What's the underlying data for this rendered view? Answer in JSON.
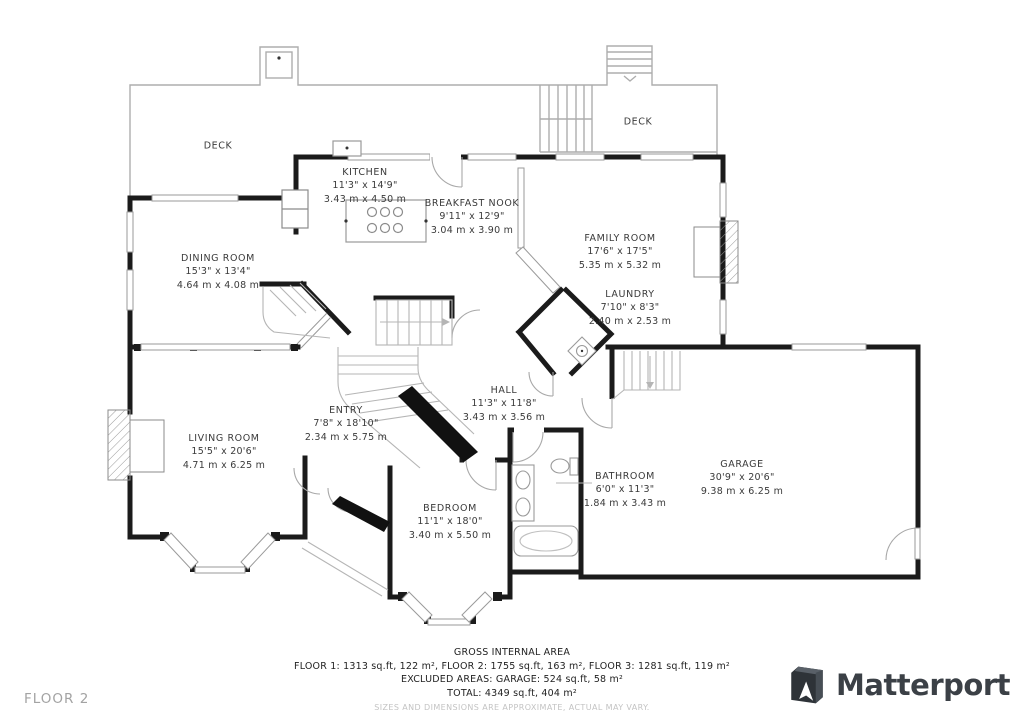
{
  "floor_label": "FLOOR 2",
  "brand": {
    "name": "Matterport"
  },
  "rooms": [
    {
      "id": "deck-left",
      "name": "DECK",
      "dims_ft": "",
      "dims_m": ""
    },
    {
      "id": "deck-right",
      "name": "DECK",
      "dims_ft": "",
      "dims_m": ""
    },
    {
      "id": "kitchen",
      "name": "KITCHEN",
      "dims_ft": "11'3\" x 14'9\"",
      "dims_m": "3.43 m x 4.50 m"
    },
    {
      "id": "breakfast-nook",
      "name": "BREAKFAST NOOK",
      "dims_ft": "9'11\" x 12'9\"",
      "dims_m": "3.04 m x 3.90 m"
    },
    {
      "id": "family-room",
      "name": "FAMILY ROOM",
      "dims_ft": "17'6\" x 17'5\"",
      "dims_m": "5.35 m x 5.32 m"
    },
    {
      "id": "dining-room",
      "name": "DINING ROOM",
      "dims_ft": "15'3\" x 13'4\"",
      "dims_m": "4.64 m x 4.08 m"
    },
    {
      "id": "laundry",
      "name": "LAUNDRY",
      "dims_ft": "7'10\" x 8'3\"",
      "dims_m": "2.40 m x 2.53 m"
    },
    {
      "id": "hall",
      "name": "HALL",
      "dims_ft": "11'3\" x 11'8\"",
      "dims_m": "3.43 m x 3.56 m"
    },
    {
      "id": "entry",
      "name": "ENTRY",
      "dims_ft": "7'8\" x 18'10\"",
      "dims_m": "2.34 m x 5.75 m"
    },
    {
      "id": "living-room",
      "name": "LIVING ROOM",
      "dims_ft": "15'5\" x 20'6\"",
      "dims_m": "4.71 m x 6.25 m"
    },
    {
      "id": "garage",
      "name": "GARAGE",
      "dims_ft": "30'9\" x 20'6\"",
      "dims_m": "9.38 m x 6.25 m"
    },
    {
      "id": "bathroom",
      "name": "BATHROOM",
      "dims_ft": "6'0\" x 11'3\"",
      "dims_m": "1.84 m x 3.43 m"
    },
    {
      "id": "bedroom",
      "name": "BEDROOM",
      "dims_ft": "11'1\" x 18'0\"",
      "dims_m": "3.40 m x 5.50 m"
    }
  ],
  "summary": {
    "title": "GROSS INTERNAL AREA",
    "floors_line": "FLOOR 1: 1313 sq.ft, 122 m², FLOOR 2: 1755 sq.ft, 163 m², FLOOR 3: 1281 sq.ft, 119 m²",
    "excluded_line": "EXCLUDED AREAS: GARAGE: 524 sq.ft, 58 m²",
    "total_line": "TOTAL: 4349 sq.ft, 404 m²",
    "disclaimer": "SIZES AND DIMENSIONS ARE APPROXIMATE, ACTUAL MAY VARY."
  },
  "colors": {
    "wall": "#1b1b1b",
    "thin_line": "#a8a8a8",
    "muted_text": "#a3a3a3",
    "brand_text": "#3b4046"
  }
}
